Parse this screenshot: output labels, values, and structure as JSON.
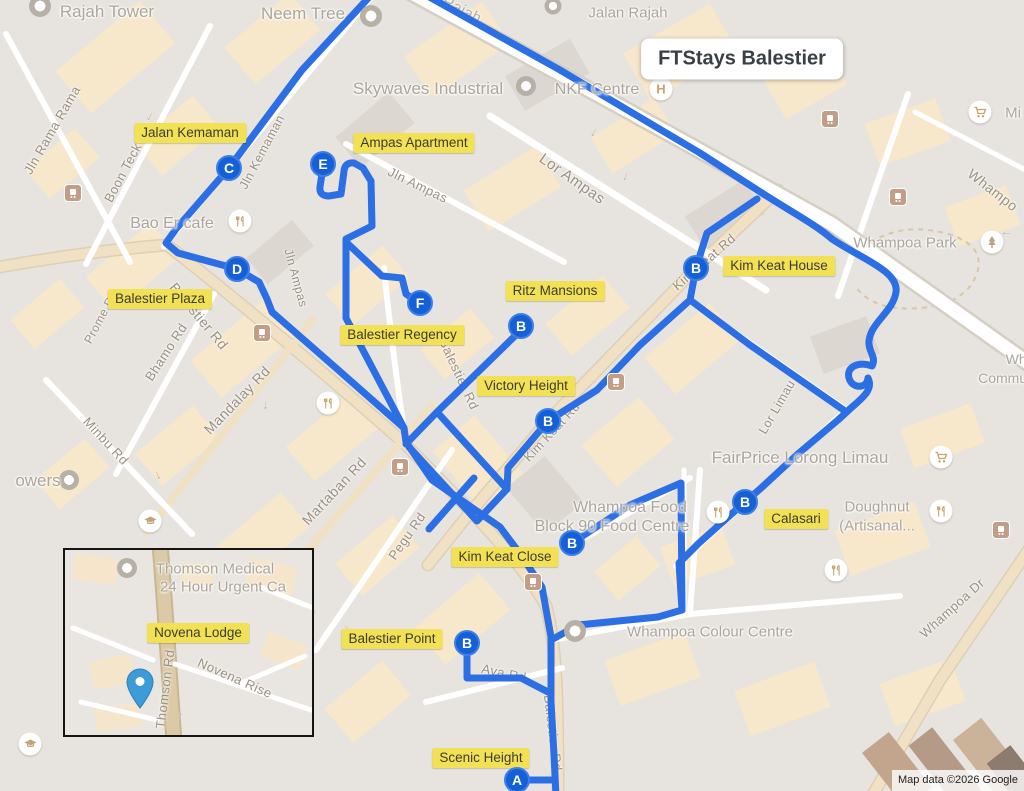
{
  "title_badge": "FTStays Balestier",
  "attribution": "Map data ©2026 Google",
  "colors": {
    "route_blue": "#2C6FE4",
    "marker_blue": "#1560D6",
    "marker_ring": "#3D7FE8",
    "highlight_yellow": "#F2E155",
    "map_background": "#E7E4DF",
    "building_peach": "#F7E7CB",
    "road_tan": "#F1E1C4",
    "poi_text_grey": "#ACA59B",
    "road_label_grey": "#9A9080",
    "inset_pin_blue": "#3D9CD8"
  },
  "markers": [
    "C",
    "E",
    "D",
    "F",
    "B",
    "B",
    "B",
    "B",
    "B",
    "B",
    "A"
  ],
  "property_labels": [
    "Jalan Kemaman",
    "Ampas Apartment",
    "Kim Keat House",
    "Ritz Mansions",
    "Balestier Plaza",
    "Balestier Regency",
    "Victory Height",
    "Calasari",
    "Kim Keat Close",
    "Balestier Point",
    "Scenic Height"
  ],
  "poi": {
    "rajah_tower": "Rajah Tower",
    "neem_tree": "Neem Tree",
    "jalan_rajah": "Jalan Rajah",
    "skywaves": "Skywaves Industrial",
    "nkf": "NKF Centre",
    "hospital_letter": "H",
    "whampoa_park": "Whampoa Park",
    "bao_er": "Bao Er cafe",
    "fairprice": "FairPrice Lorong Limau",
    "doughnut_line1": "Doughnut",
    "doughnut_line2": "(Artisanal...",
    "whampoa_food_line1": "Whampoa Food",
    "whampoa_food_line2": "Block 90 Food Centre",
    "whampoa_colour": "Whampoa Colour Centre",
    "mi_fragment": "Mi",
    "towers_fragment": "owers",
    "community_line1": "Wha",
    "community_line2": "Communit"
  },
  "road_labels": [
    "Rajah",
    "Jln Rama Rama",
    "Boon Teck Rd",
    "Jln Kemaman",
    "Balestier Rd",
    "Balestier Rd",
    "Balestier Rd",
    "Bhamo Rd",
    "Prome Rd",
    "Minbu Rd",
    "Mandalay Rd",
    "Martaban Rd",
    "Pegu Rd",
    "Jln Ampas",
    "Jln Ampas",
    "Lor Ampas",
    "Kim Keat Rd",
    "Kim Keat Rd",
    "Lor Limau",
    "Whampoa Dr",
    "Whampo",
    "Ava Rd"
  ],
  "inset": {
    "novena_lodge": "Novena Lodge",
    "thomson_medical_line1": "Thomson Medical",
    "thomson_medical_line2": "24 Hour Urgent Ca",
    "novena_rise": "Novena Rise",
    "thomson_rd": "Thomson Rd"
  },
  "icons": {
    "arrow_glyph": "↑"
  }
}
